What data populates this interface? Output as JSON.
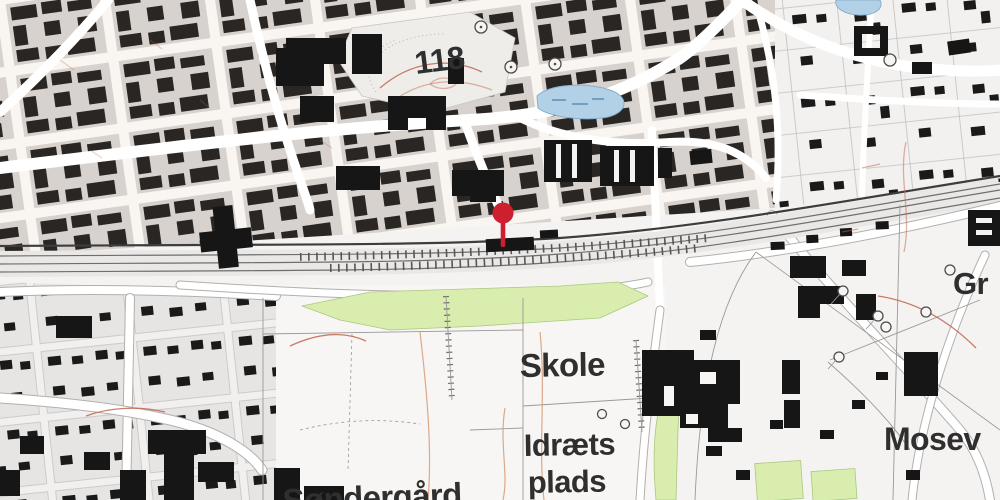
{
  "map": {
    "labels": [
      {
        "id": "elevation-118",
        "text": "118",
        "x": 416,
        "y": 74,
        "size": 32,
        "rotate": -7
      },
      {
        "id": "skole",
        "text": "Skole",
        "x": 520,
        "y": 377,
        "size": 33,
        "rotate": -1
      },
      {
        "id": "idraetsplads-line1",
        "text": "Idræts",
        "x": 524,
        "y": 456,
        "size": 31,
        "rotate": -1
      },
      {
        "id": "idraetsplads-line2",
        "text": "plads",
        "x": 528,
        "y": 493,
        "size": 31,
        "rotate": -1
      },
      {
        "id": "soendergaard",
        "text": "Søndergård",
        "x": 283,
        "y": 512,
        "size": 33,
        "rotate": -2
      },
      {
        "id": "mosev",
        "text": "Mosev",
        "x": 884,
        "y": 450,
        "size": 32,
        "rotate": 0
      },
      {
        "id": "gr",
        "text": "Gr",
        "x": 953,
        "y": 294,
        "size": 31,
        "rotate": 0
      }
    ],
    "marker": {
      "x": 503,
      "y": 213,
      "r": 10.5,
      "stem_width": 4.6,
      "stem_bottom": 247,
      "color": "#ce1f2e"
    },
    "palette": {
      "background": "#f5f3f1",
      "parcel": "#d6d4d2",
      "building": "#161616",
      "road": "#ffffff",
      "road_casing": "#b2b0ae",
      "rail_dark": "#3d3d3d",
      "green": "#d9edae",
      "water": "#b3d1e6",
      "contour_red": "#bf6750",
      "marker_red": "#ce1f2e",
      "label_gray": "#2f2f2f"
    }
  }
}
